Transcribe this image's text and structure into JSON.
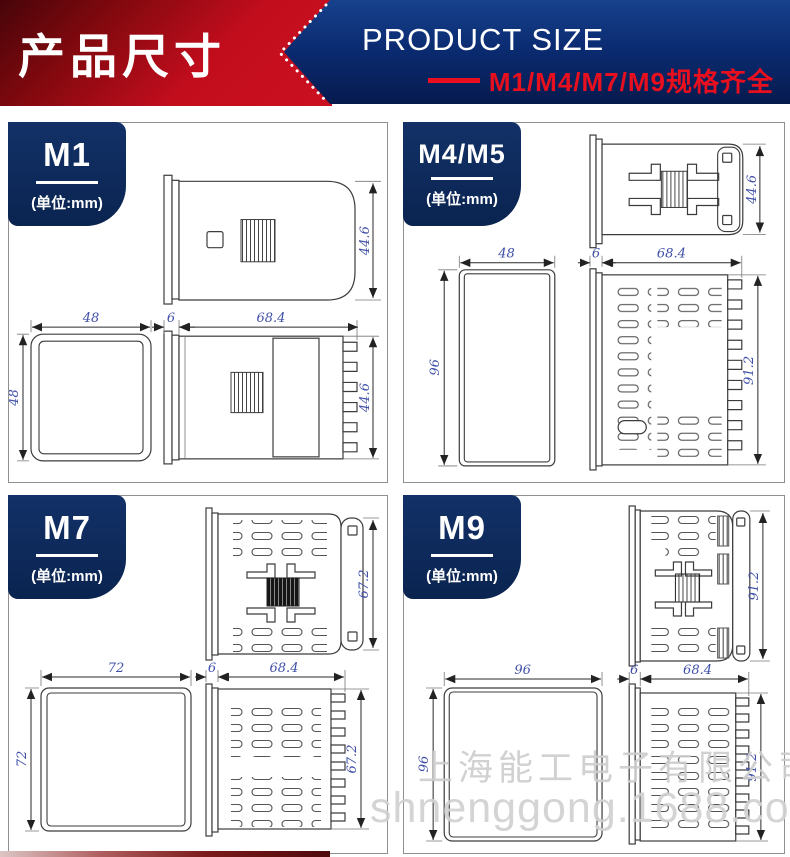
{
  "header": {
    "title_cn": "产品尺寸",
    "title_en": "PRODUCT SIZE",
    "subtitle": "M1/M4/M7/M9规格齐全"
  },
  "colors": {
    "banner_red": "#c20d1d",
    "banner_navy": "#0b2c72",
    "badge_navy": "#0d2b5e",
    "subtitle_red": "#e8101e",
    "dim_text_blue": "#4050a8",
    "watermark_gray": "#d2d2d2"
  },
  "panels": [
    {
      "id": "m1",
      "label": "M1",
      "unit": "(单位:mm)",
      "dims": {
        "top_height": "44.6",
        "front_width": "48",
        "front_height": "48",
        "bezel": "6",
        "depth": "68.4",
        "side_height": "44.6"
      }
    },
    {
      "id": "m4m5",
      "label": "M4/M5",
      "unit": "(单位:mm)",
      "dims": {
        "top_height": "44.6",
        "front_width": "48",
        "front_height": "96",
        "bezel": "6",
        "depth": "68.4",
        "side_height": "91.2"
      }
    },
    {
      "id": "m7",
      "label": "M7",
      "unit": "(单位:mm)",
      "dims": {
        "top_height": "67.2",
        "front_width": "72",
        "front_height": "72",
        "bezel": "6",
        "depth": "68.4",
        "side_height": "67.2"
      }
    },
    {
      "id": "m9",
      "label": "M9",
      "unit": "(单位:mm)",
      "dims": {
        "top_height": "91.2",
        "front_width": "96",
        "front_height": "96",
        "bezel": "6",
        "depth": "68.4",
        "side_height": "91.2"
      }
    }
  ],
  "watermark": {
    "company": "上海能工电子有限公司",
    "site": "shnenggong.1688.com"
  }
}
